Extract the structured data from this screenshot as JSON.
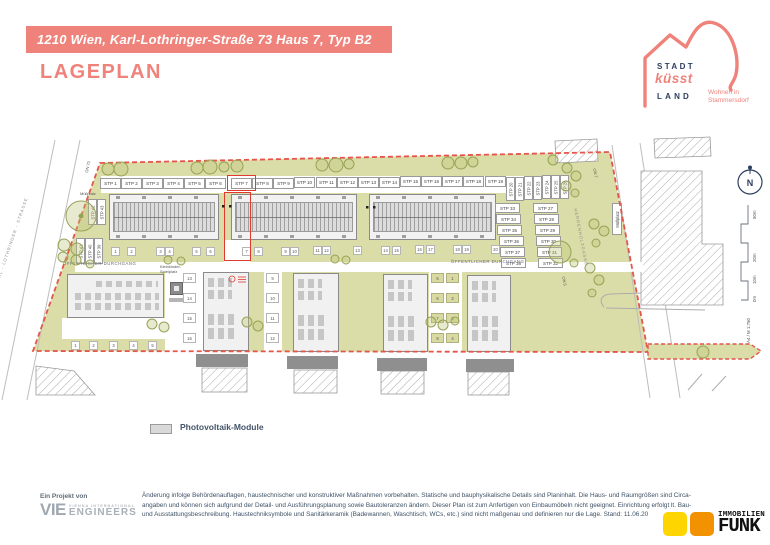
{
  "header": {
    "address_banner": "1210 Wien, Karl-Lothringer-Straße 73 Haus 7, Typ B2",
    "page_title": "LAGEPLAN"
  },
  "brand": {
    "stadt": "STADT",
    "kuesst": "küsst",
    "land": "LAND",
    "tagline_line1": "Wohnen in",
    "tagline_line2": "Stammersdorf"
  },
  "plan": {
    "streets": {
      "left": "KARL - LOTHRINGER - STRASSE",
      "right": "HERRENHOLZGASSE"
    },
    "labels": {
      "muellplatz_left": "Müllplatz",
      "muellplatz_right": "Müllplatz",
      "durchgang_left": "ÖFFENTLICHER DURCHGANG",
      "durchgang_right": "ÖFFENTLICHER DURCHGANG",
      "spielplatz_line1": "Kleinkinder-",
      "spielplatz_line2": "Spielplatz",
      "on7": "ON 7",
      "on5": "ON 5",
      "on73": "ON 73",
      "north": "N",
      "scale": [
        "0m",
        "10m",
        "20m",
        "50m"
      ],
      "sheet": "A4 / M 1:750"
    },
    "stp_top": [
      "STP 1",
      "STP 2",
      "STP 3",
      "STP 4",
      "STP 5",
      "STP 6",
      "STP 7",
      "STP 8",
      "STP 9",
      "STP 10",
      "STP 11",
      "STP 12",
      "STP 13",
      "STP 14",
      "STP 15",
      "STP 16",
      "STP 17",
      "STP 18",
      "STP 19"
    ],
    "stp_rotated": [
      "STP 20",
      "STP 21",
      "STP 22",
      "STP 23",
      "STP 24",
      "STP 25",
      "STP 26"
    ],
    "stp_col_inner": [
      "STP 33",
      "STP 34",
      "STP 35",
      "STP 36",
      "STP 37",
      "STP 38"
    ],
    "stp_col_outer": [
      "STP 27",
      "STP 28",
      "STP 29",
      "STP 30",
      "STP 31",
      "STP 32"
    ],
    "stp_left_top": [
      "STP 42",
      "STP 43"
    ],
    "stp_left_bottom": [
      "STP 41",
      "STP 40",
      "STP 39"
    ],
    "house_numbers_top": [
      "1",
      "2",
      "3",
      "4",
      "5",
      "6",
      "7",
      "8",
      "9",
      "10",
      "11",
      "12",
      "13",
      "14",
      "15",
      "16",
      "17",
      "18",
      "19",
      "20"
    ],
    "house_numbers_col_a": [
      "13",
      "14",
      "15",
      "16"
    ],
    "house_numbers_col_b": [
      "9",
      "10",
      "11",
      "12"
    ],
    "house_numbers_col_c": [
      "5",
      "6",
      "7",
      "8"
    ],
    "house_numbers_col_d": [
      "1",
      "2",
      "3",
      "4"
    ],
    "house_numbers_row_d": [
      "1",
      "2",
      "3",
      "4",
      "5"
    ]
  },
  "legend": {
    "pv_label": "Photovoltaik-Module"
  },
  "footer": {
    "project_prefix": "Ein Projekt von",
    "vie": {
      "abbr": "VIE",
      "line1": "VIENNA INTERNATIONAL",
      "line2": "ENGINEERS"
    },
    "disclaimer_lines": [
      "Änderung infolge Behördenauflagen, haustechnischer und konstruktiver Maßnahmen vorbehalten. Statische und bauphysikalische Details sind Planinhalt. Die Haus- und Raumgrößen sind Circa-",
      "angaben und können sich aufgrund der Detail- und Ausführungsplanung sowie Bautoleranzen ändern. Dieser Plan ist zum Anfertigen von Einbaumöbeln nicht geeignet. Einrichtung erfolgt lt. Bau-",
      "und Ausstattungsbeschreibung. Haustechniksymbole und Sanitärkeramik (Badewannen, Waschtisch, WCs, etc.) sind nicht maßgenau und definieren nur die Lage.  Stand: 11.06.20"
    ],
    "funk": {
      "line1": "IMMOBILIEN",
      "line2": "FUNK"
    }
  },
  "colors": {
    "coral": "#EF837B",
    "navy": "#2D3E5F",
    "site_green": "#DBDDA8",
    "boundary_red": "#E4554A",
    "funk_yellow": "#FFD500",
    "funk_orange": "#F39200"
  }
}
